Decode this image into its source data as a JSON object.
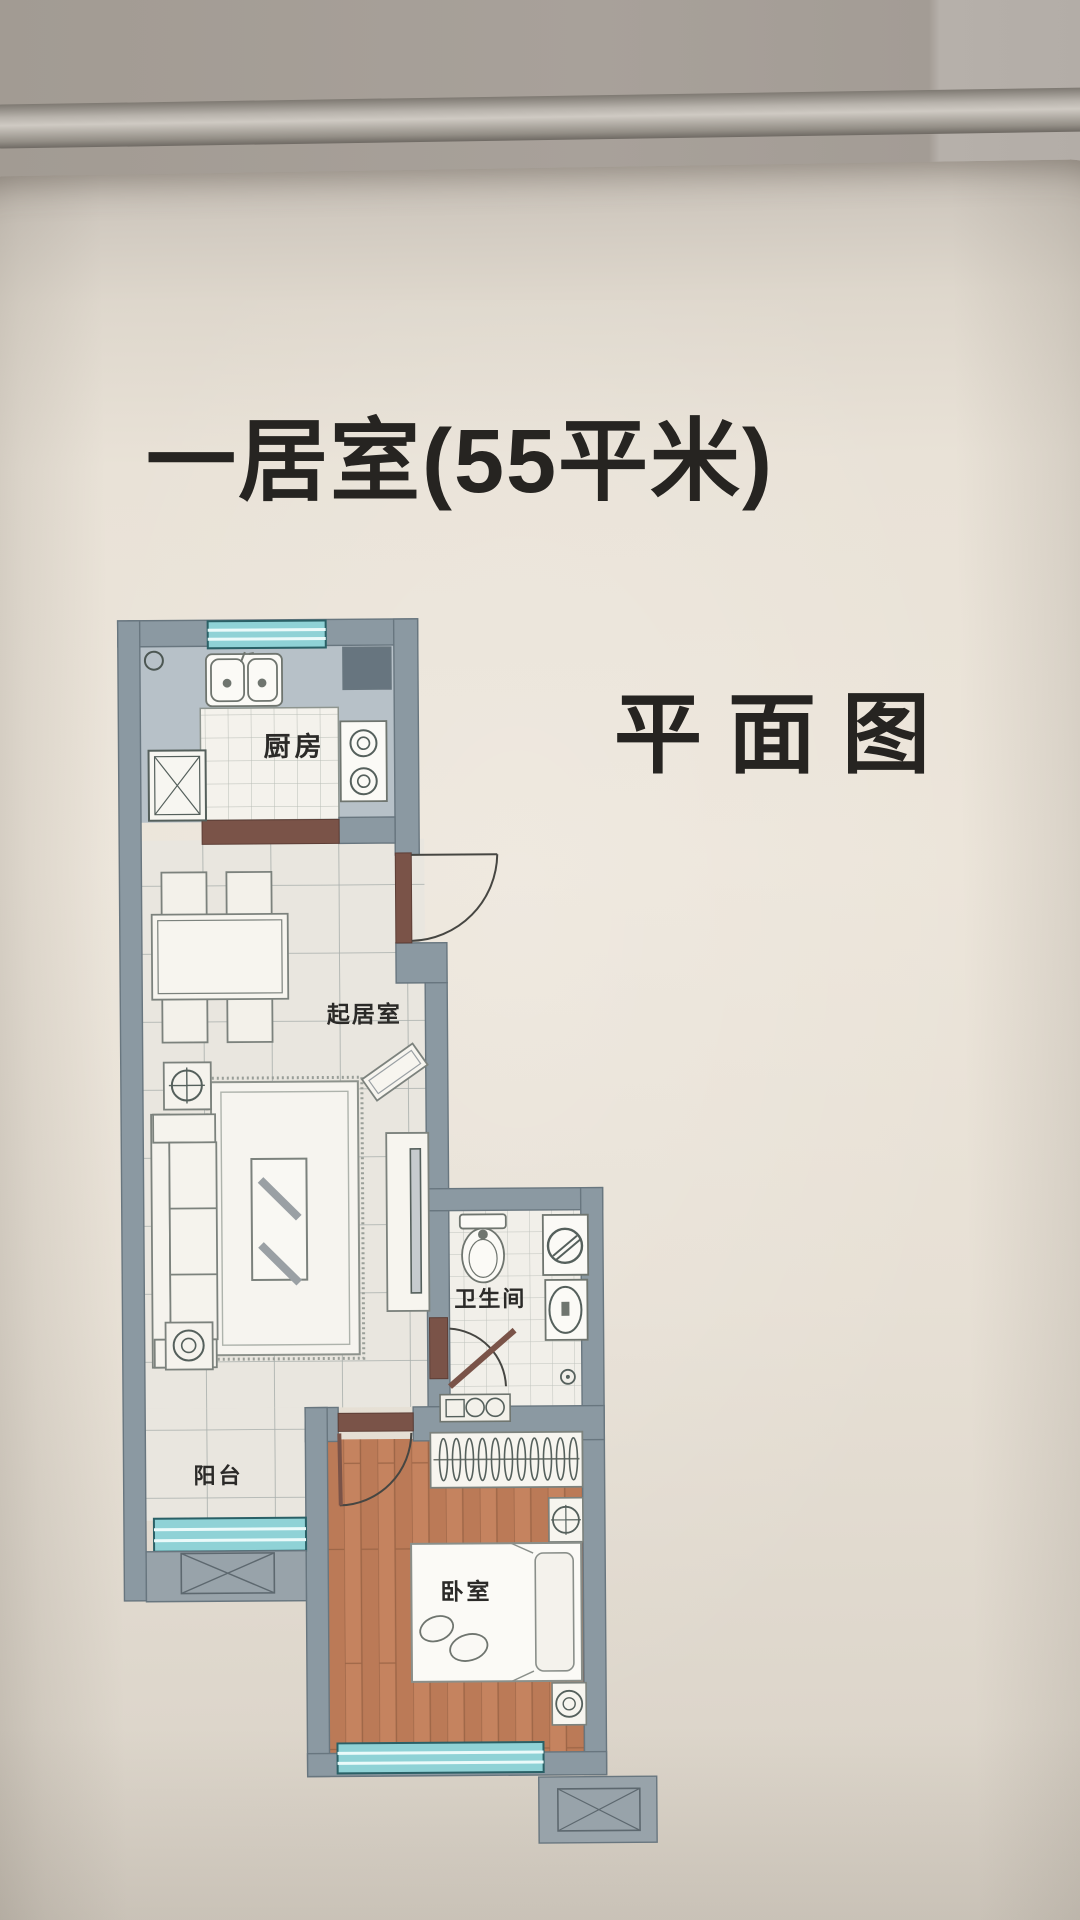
{
  "header": {
    "title": "一居室(55平米)",
    "subtitle": "平面图"
  },
  "floor_plan": {
    "labels": {
      "kitchen": "厨房",
      "living": "起居室",
      "bathroom": "卫生间",
      "balcony": "阳台",
      "bedroom": "卧室"
    },
    "colors": {
      "wall": "#8b99a2",
      "window_glass": "#8fd2d6",
      "wood_floor": "#c2805f",
      "tile_floor": "#e9e6df",
      "threshold": "#7a5348",
      "label_text": "#2b2a28"
    }
  }
}
